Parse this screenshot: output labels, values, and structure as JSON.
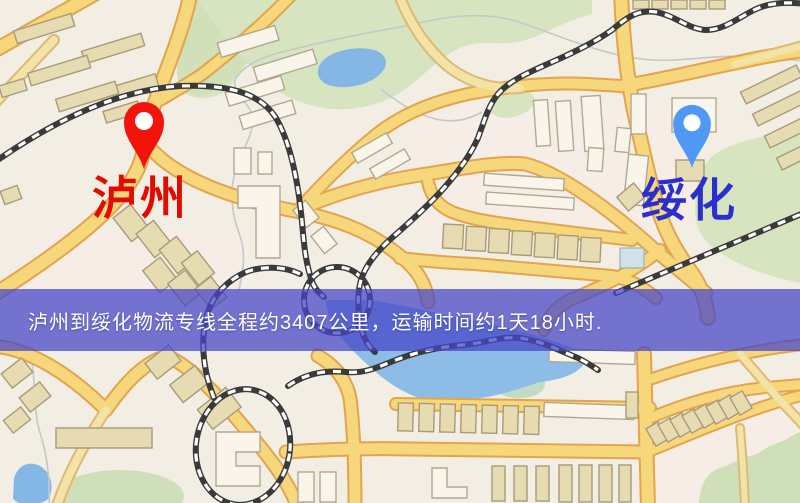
{
  "map": {
    "background_color": "#f3eee4",
    "park_color": "#d7e4c0",
    "water_color": "#84b7e6",
    "road_fill_color": "#f6d77b",
    "road_casing_color": "#e2a44e",
    "railway_color": "#3a3a3a",
    "building_white_color": "#f9f5ea",
    "building_tan_color": "#e7dbb2"
  },
  "route": {
    "origin": "泸州",
    "destination": "绥化",
    "distance_km": "3407",
    "duration": "1天18小时"
  },
  "markers": {
    "origin": {
      "name": "泸州",
      "pin_icon": "map-pin-icon",
      "pin_color": "#f2140a",
      "label_color": "#e30b00"
    },
    "destination": {
      "name": "绥化",
      "pin_icon": "map-pin-icon",
      "pin_color": "#4f99f5",
      "label_color": "#2b2fce"
    }
  },
  "banner": {
    "text": "泸州到绥化物流专线全程约3407公里，运输时间约1天18小时.",
    "background_color": "rgba(70,70,200,0.74)",
    "text_color": "#ffffff"
  }
}
